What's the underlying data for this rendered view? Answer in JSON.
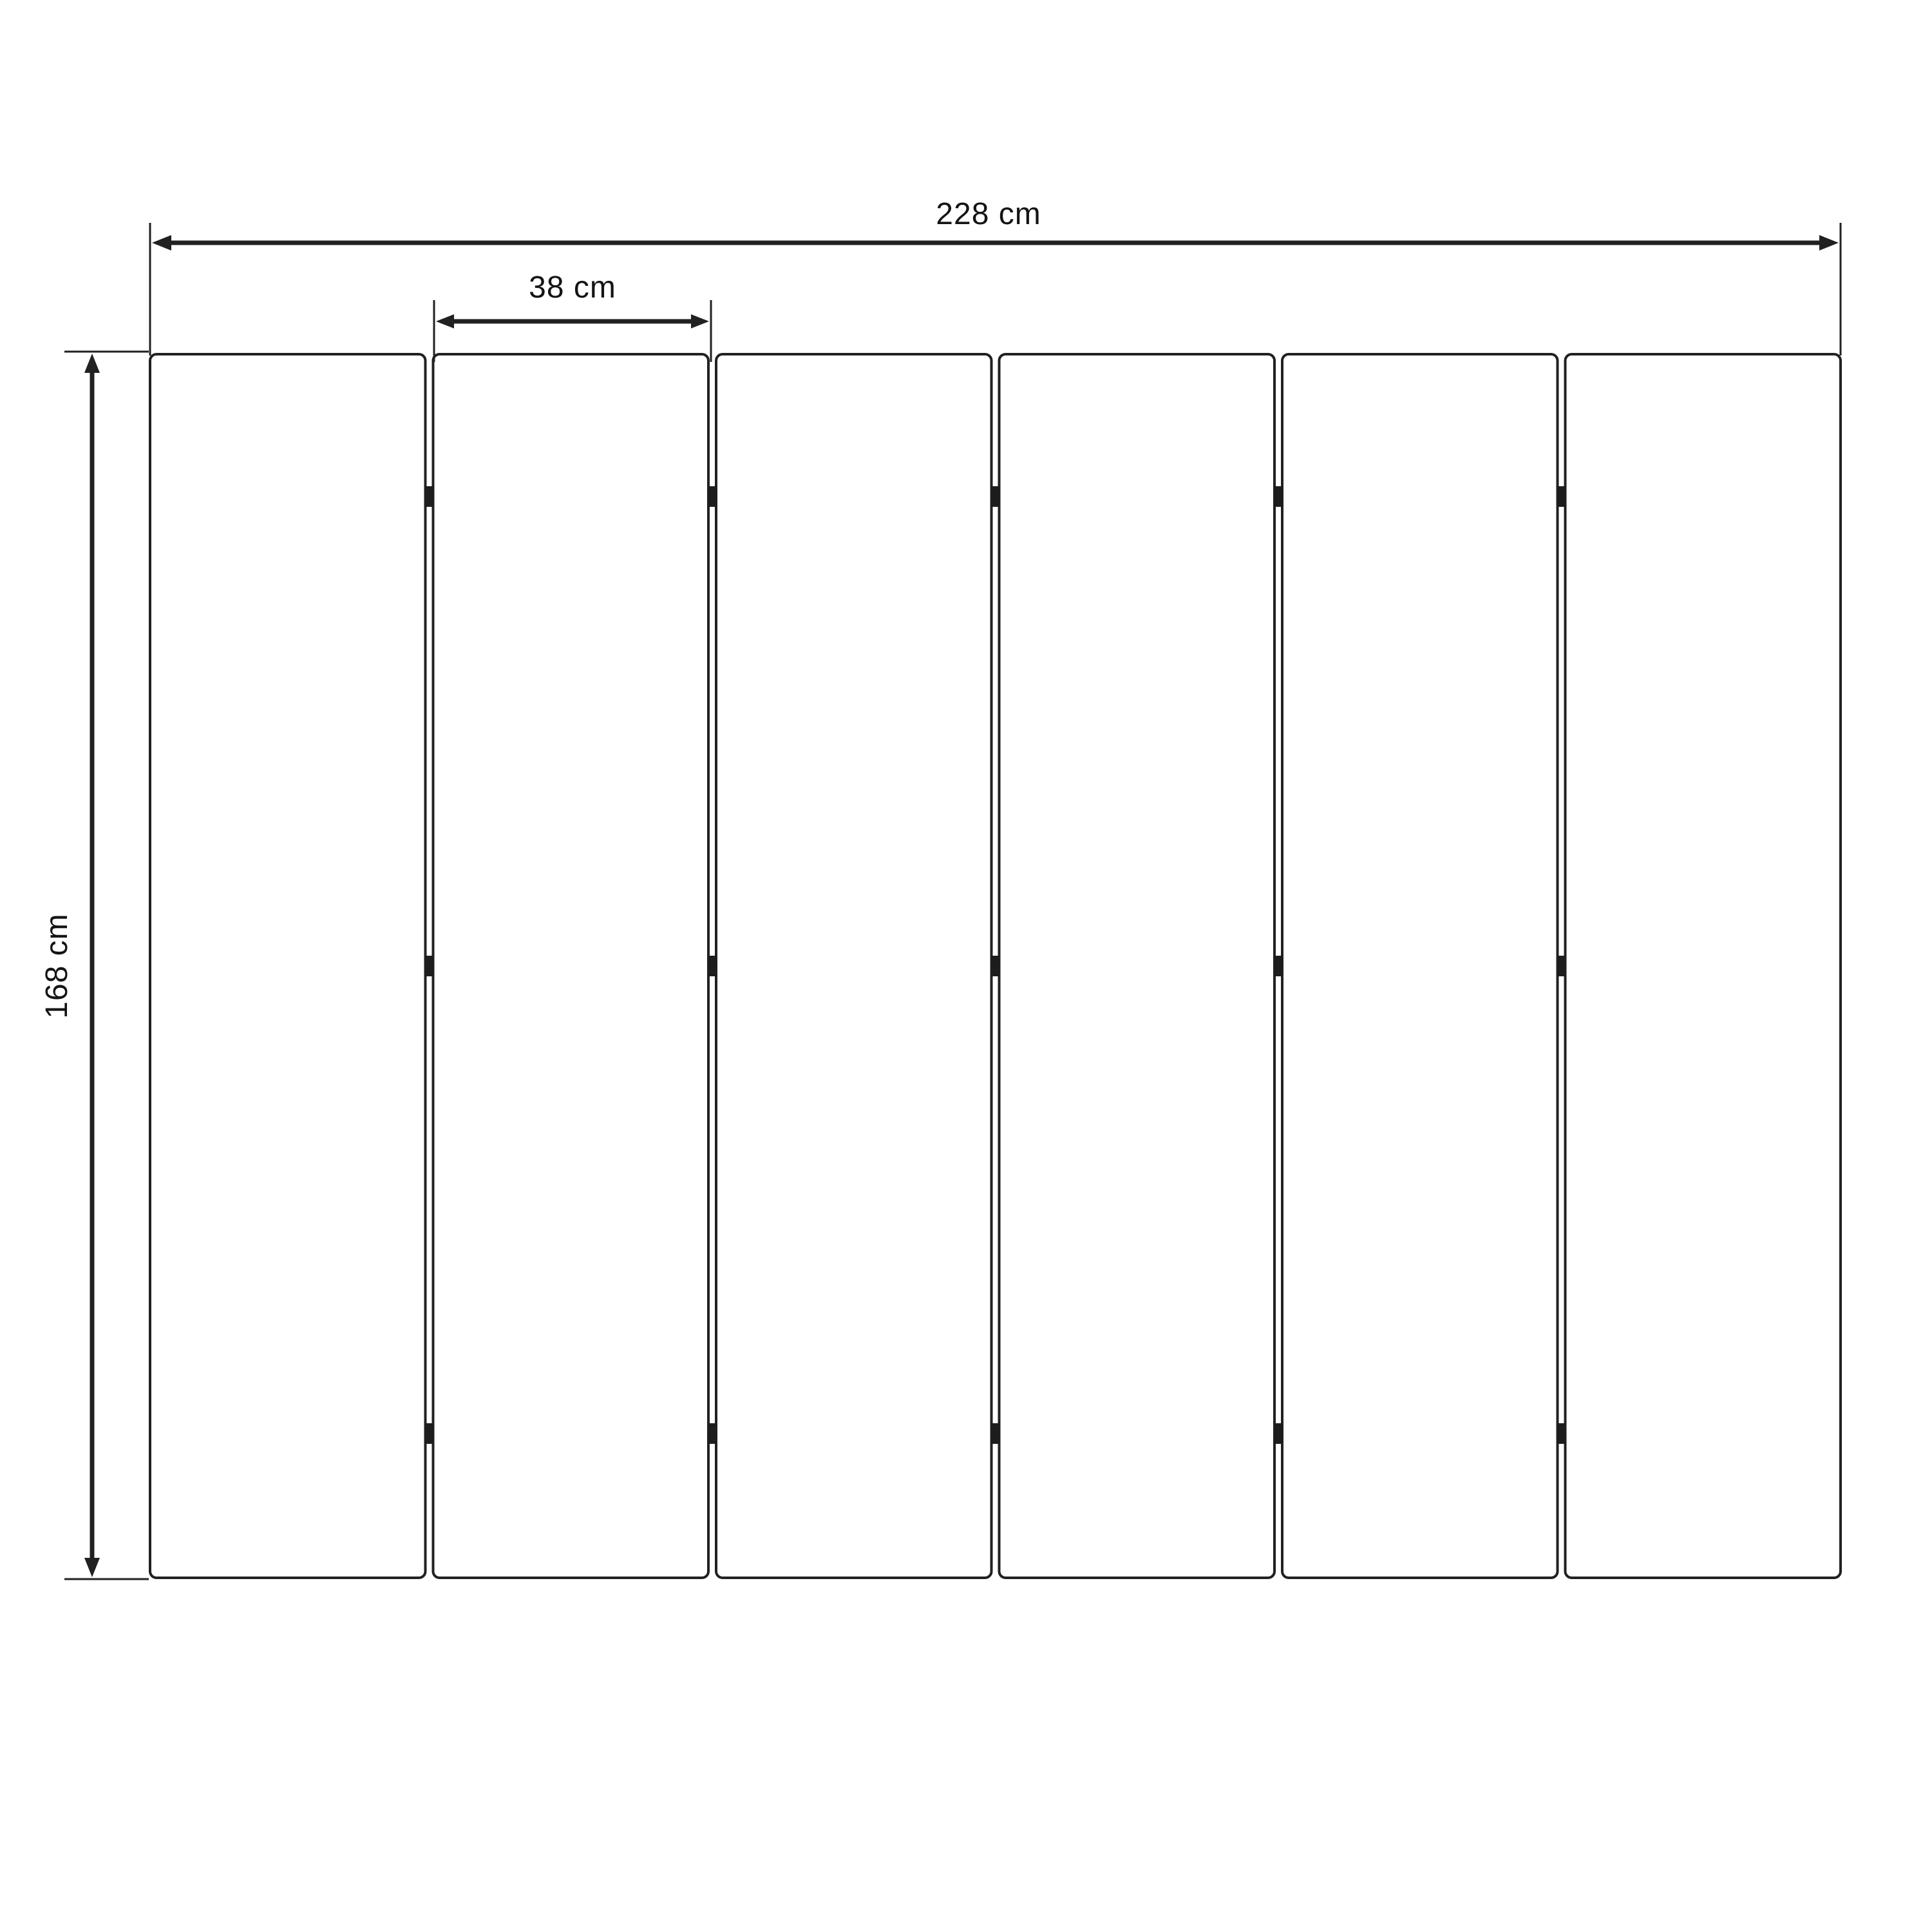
{
  "diagram": {
    "panels": {
      "count": 6,
      "hinge_rows_per_joint": 3
    },
    "dimensions": {
      "total_width_label": "228 cm",
      "panel_width_label": "38 cm",
      "height_label": "168 cm"
    },
    "colors": {
      "background": "#ffffff",
      "line": "#212121",
      "text": "#141414"
    }
  }
}
